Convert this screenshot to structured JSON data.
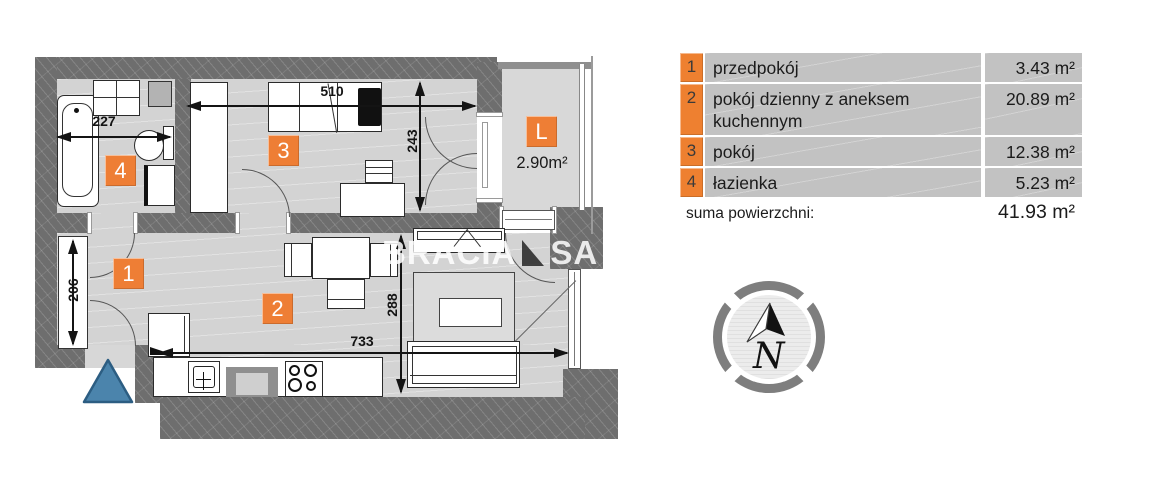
{
  "plan": {
    "markers": {
      "hall": "1",
      "living": "2",
      "room": "3",
      "bath": "4",
      "loggia": "L"
    },
    "loggia_area": "2.90m²",
    "dims": {
      "bath_w": "227",
      "room3_w": "510",
      "room3_d": "243",
      "hall_d": "206",
      "living_d": "288",
      "living_w": "733"
    },
    "watermark": {
      "part1": "BRACIA",
      "part2": "SA"
    }
  },
  "legend": {
    "rows": [
      {
        "number": "1",
        "name": "przedpokój",
        "area": "3.43 m²"
      },
      {
        "number": "2",
        "name": "pokój dzienny z aneksem kuchennym",
        "area": "20.89 m²"
      },
      {
        "number": "3",
        "name": "pokój",
        "area": "12.38 m²"
      },
      {
        "number": "4",
        "name": "łazienka",
        "area": "5.23 m²"
      }
    ],
    "total_label": "suma powierzchni:",
    "total_value": "41.93 m²"
  },
  "compass": {
    "north": "N"
  },
  "colors": {
    "accent_orange": "#ee7e35",
    "wall_gray": "#6e6e6e",
    "floor_gray": "#d3d3d3",
    "legend_gray": "#c2c2c2",
    "entrance_blue": "#4b84ac"
  }
}
